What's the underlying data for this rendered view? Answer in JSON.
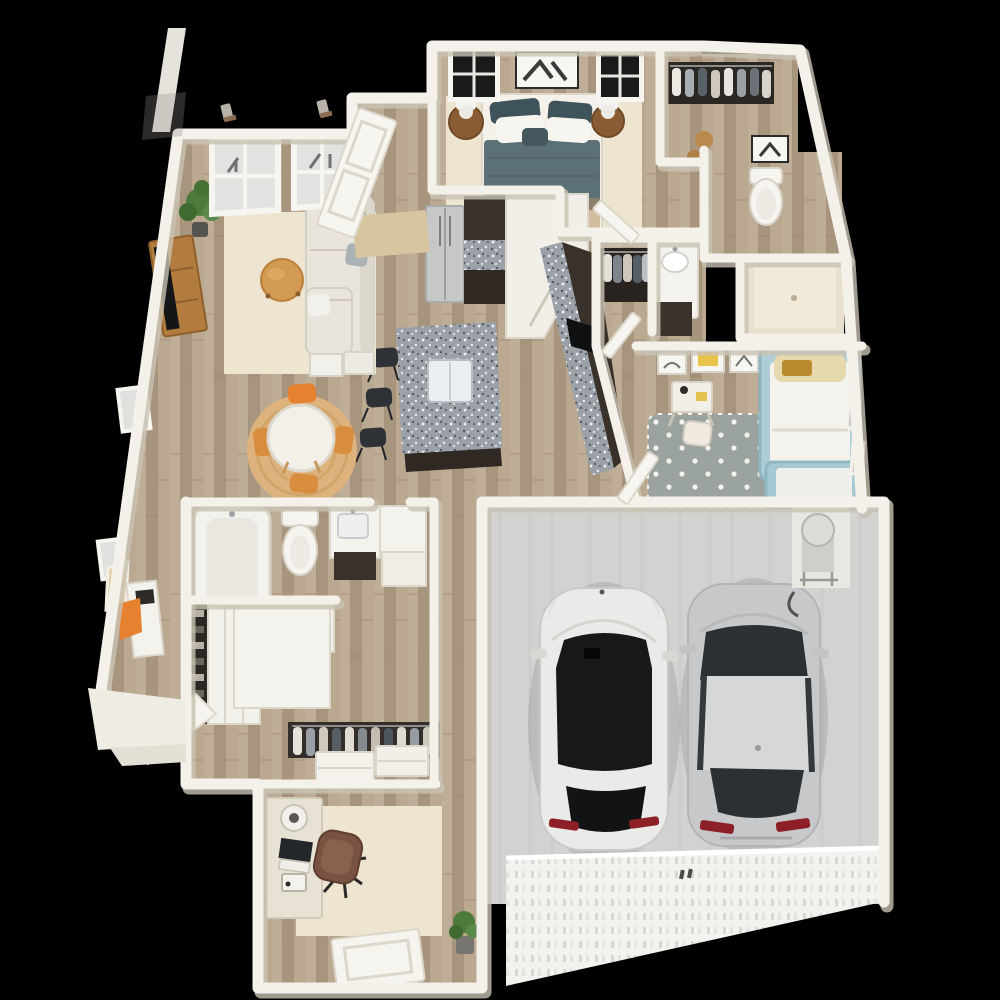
{
  "scene": {
    "description": "3D top-down dollhouse rendering of a two-bedroom apartment floor plan with attached two-car garage on a black background",
    "background_color": "#000000"
  },
  "palette": {
    "background": "#000000",
    "wall": "#f4f1ea",
    "wallShadow": "#c9c2b3",
    "woodFloor": "#b5a28c",
    "garageFloor": "#d3d2d0",
    "garageDoor": "#f3f2ef",
    "rugCream": "#eee5d1",
    "rugJute": "#ddb27d",
    "kidsRug": "#9aa39d",
    "duvetTeal": "#5c7176",
    "pillowDark": "#3f545a",
    "blanketTan": "#cfbd9d",
    "sofa": "#e9e5dd",
    "woodFurniture": "#b27c3f",
    "tableTop": "#f3f0e9",
    "accentOrange": "#e5812f",
    "cabinetDark": "#3a312a",
    "granite": "#9aa1a8",
    "steel": "#c6c8c8",
    "kidsBlue": "#aecdd7",
    "carWhite": "#eaeae8",
    "carSilver": "#c6c8c9",
    "glassDark": "#16181a",
    "tailRed": "#8c2026",
    "plantGreen": "#4e7a3c",
    "doorMat": "#d8c5a0",
    "showerStone": "#e9dfcd",
    "fixtureWhite": "#f4f2ec"
  },
  "rooms": [
    {
      "id": "master-bedroom",
      "furniture": [
        "queen-bed-teal-duvet",
        "two-round-nightstands",
        "two-white-lamps",
        "two-windows",
        "wall-art",
        "cream-rug"
      ]
    },
    {
      "id": "walk-in-closet",
      "furniture": [
        "hanging-clothes-rod",
        "storage-stools"
      ]
    },
    {
      "id": "master-toilet-room",
      "furniture": [
        "toilet",
        "framed-art"
      ]
    },
    {
      "id": "shower-room",
      "furniture": [
        "walk-in-shower"
      ]
    },
    {
      "id": "hall-bathroom",
      "furniture": [
        "vanity-sink",
        "dark-cabinet"
      ]
    },
    {
      "id": "hall-closet",
      "furniture": [
        "hanging-clothes"
      ]
    },
    {
      "id": "kitchen",
      "furniture": [
        "stainless-fridge",
        "dark-cabinets-granite",
        "corner-pantry",
        "granite-island-with-sink",
        "three-bar-stools",
        "long-granite-counter"
      ]
    },
    {
      "id": "dining-area",
      "furniture": [
        "round-white-table",
        "four-orange-wood-chairs",
        "round-jute-rug"
      ]
    },
    {
      "id": "living-room",
      "furniture": [
        "l-shaped-light-sofa",
        "round-wood-coffee-table",
        "tv-on-wood-console",
        "potted-plant",
        "cream-area-rug",
        "two-windows",
        "console-table",
        "orange-accent-chair",
        "leaning-frame"
      ]
    },
    {
      "id": "entry",
      "furniture": [
        "open-front-door",
        "tan-door-mat"
      ]
    },
    {
      "id": "kids-bedroom",
      "furniture": [
        "light-blue-bed",
        "lower-blue-bench",
        "small-desk",
        "desk-chair",
        "three-wall-frames",
        "polka-dot-rug",
        "side-windows"
      ]
    },
    {
      "id": "main-bathroom",
      "furniture": [
        "bathtub",
        "toilet",
        "vanity-dark-base",
        "white-corner-cabinet"
      ]
    },
    {
      "id": "wardrobe-corridor",
      "furniture": [
        "open-shoe-shelf",
        "white-wardrobe",
        "hanging-clothes-rod",
        "two-white-dressers",
        "open-door"
      ]
    },
    {
      "id": "office",
      "furniture": [
        "desk-with-laptop",
        "desk-lamp",
        "printer",
        "brown-office-chair",
        "cream-rug",
        "potted-plant",
        "exterior-door"
      ]
    },
    {
      "id": "garage",
      "furniture": [
        "water-heater-on-stand",
        "ribbed-garage-door",
        "entry-door"
      ]
    }
  ],
  "vehicles": [
    {
      "id": "car-left",
      "type": "white-crossover-suv",
      "body_color": "#eaeae8",
      "roof": "black-panoramic-glass"
    },
    {
      "id": "car-right",
      "type": "silver-sedan",
      "body_color": "#c6c8c9",
      "roof": "silver"
    }
  ],
  "exterior": [
    "diagonal-roof-line-artifact",
    "two-wall-sconces",
    "front-porch-step",
    "black-void-background"
  ]
}
